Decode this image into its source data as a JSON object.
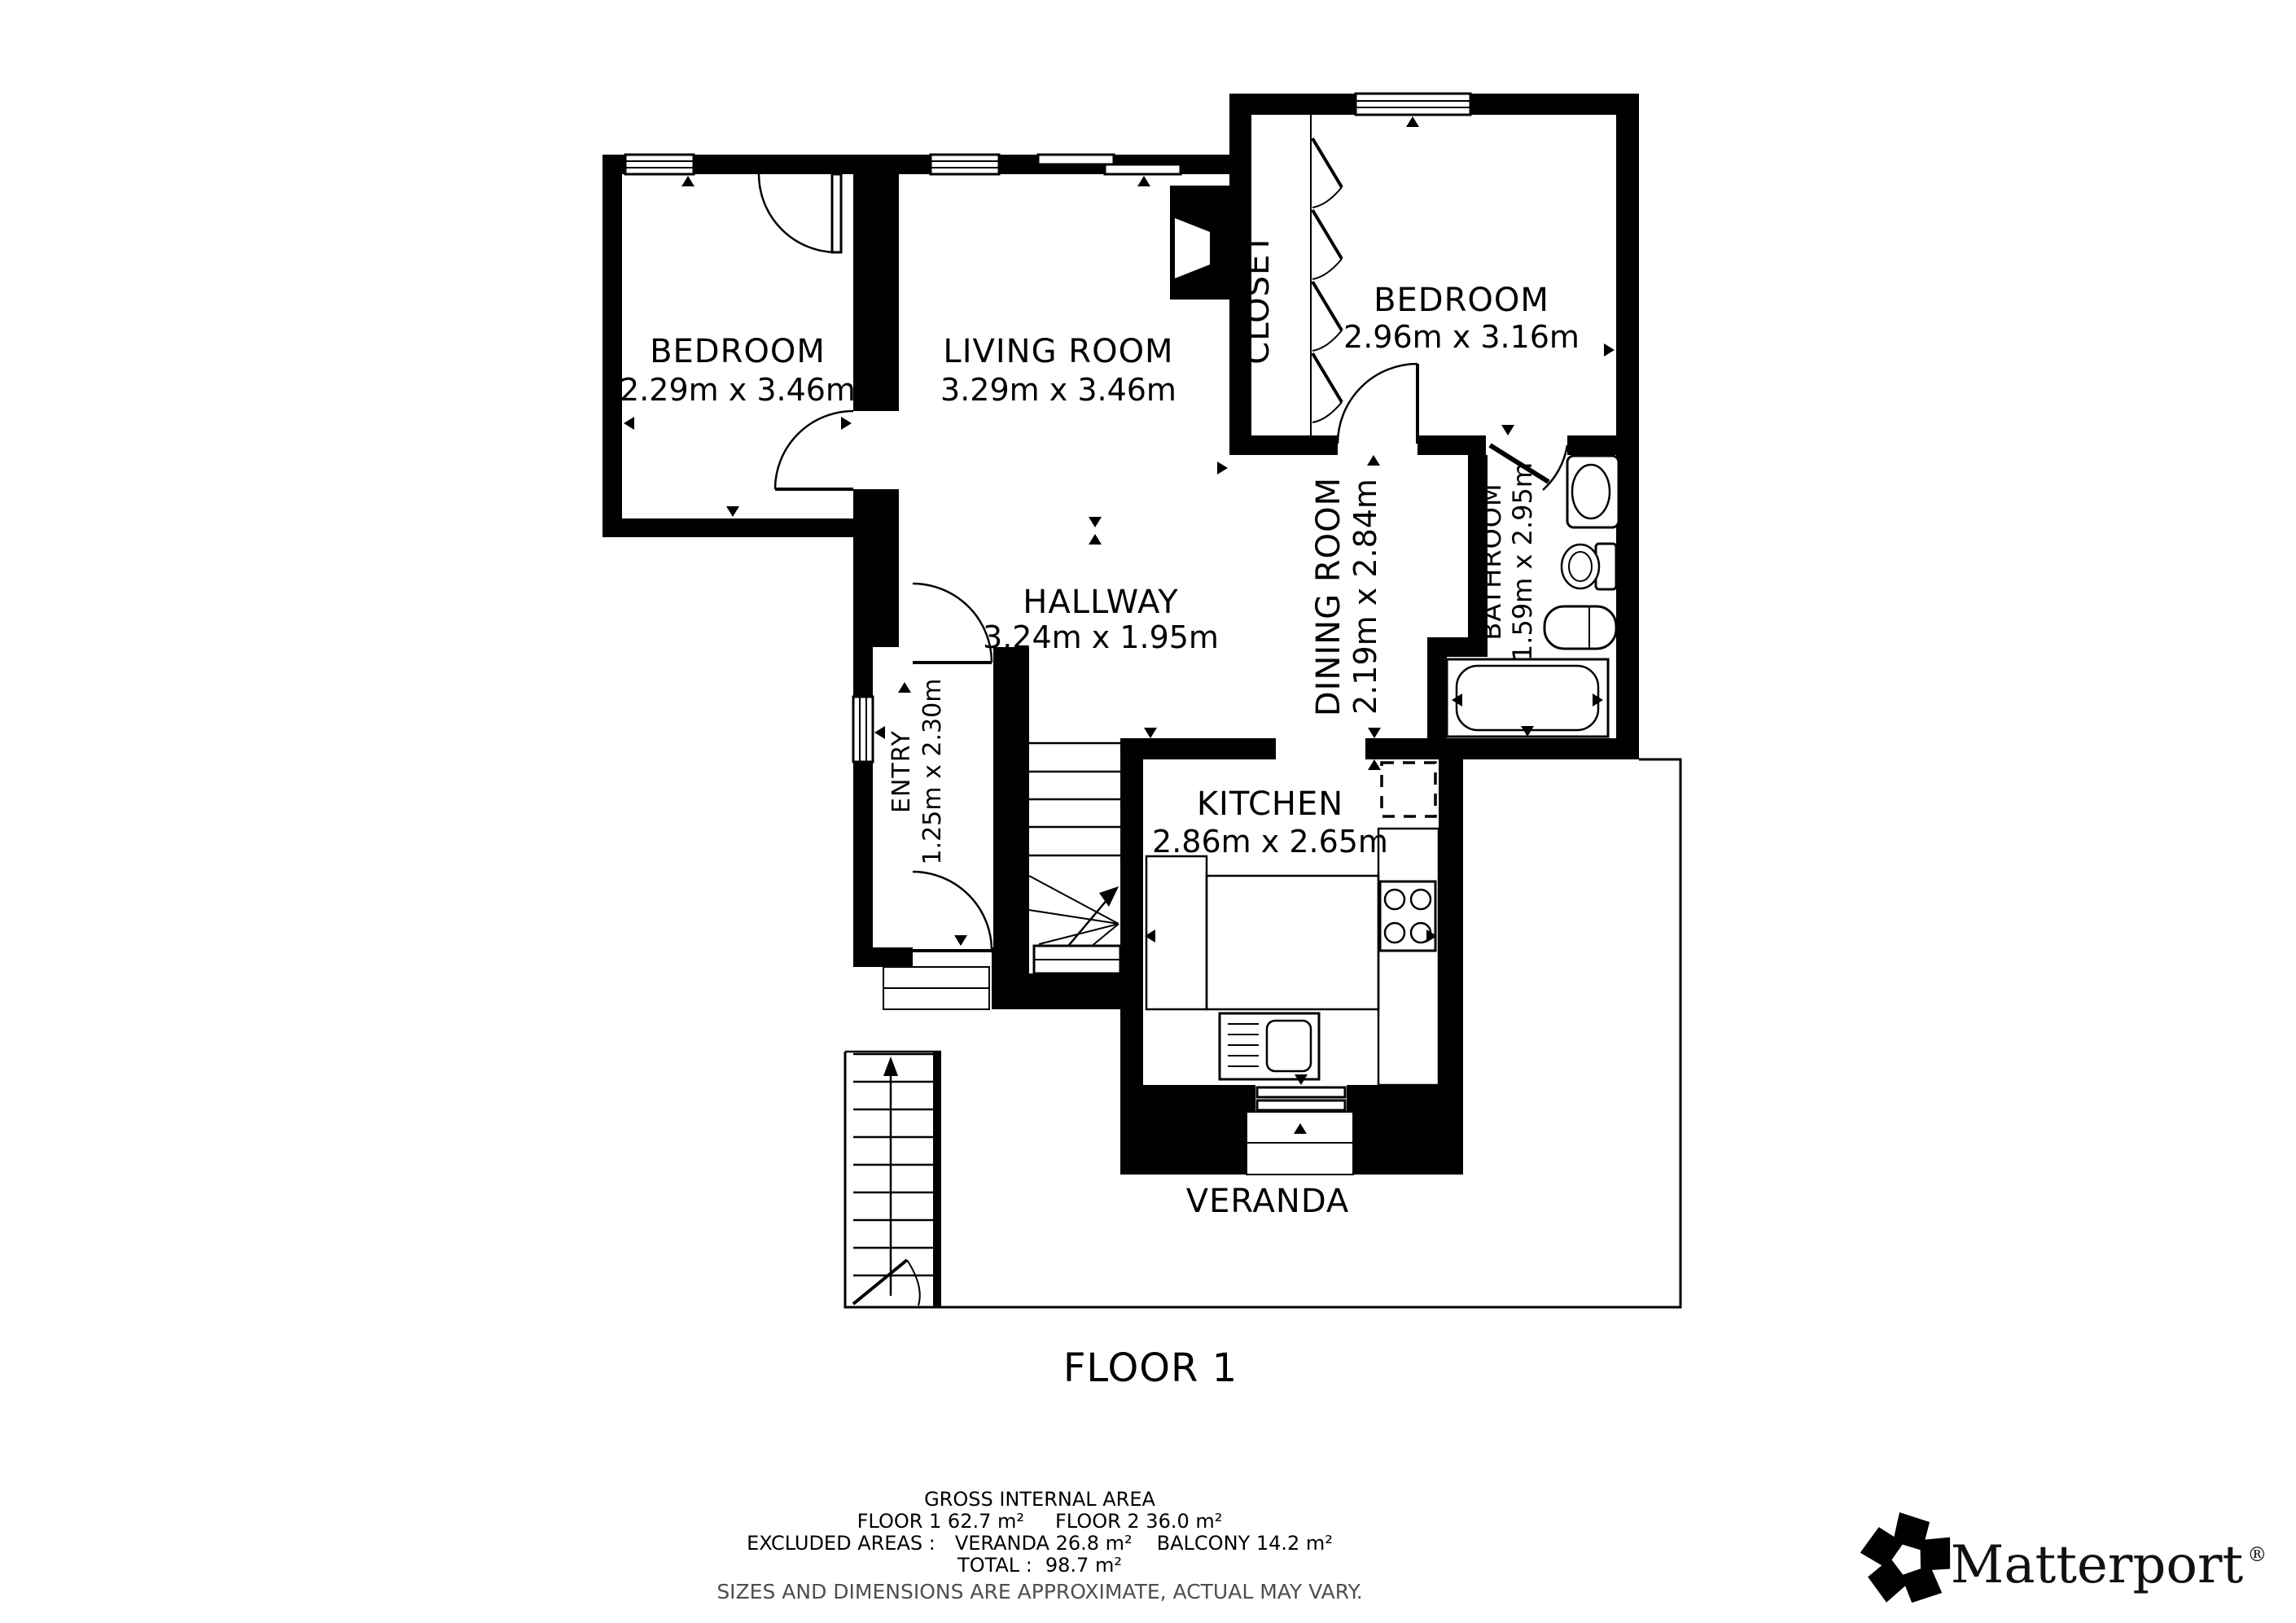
{
  "plan": {
    "floor_label": "FLOOR 1",
    "rooms": {
      "bedroom1": {
        "name": "BEDROOM",
        "dims": "2.29m x 3.46m"
      },
      "living": {
        "name": "LIVING ROOM",
        "dims": "3.29m x 3.46m"
      },
      "closet": {
        "name": "CLOSET"
      },
      "bedroom2": {
        "name": "BEDROOM",
        "dims": "2.96m x 3.16m"
      },
      "dining": {
        "name": "DINING ROOM",
        "dims": "2.19m x 2.84m"
      },
      "bathroom": {
        "name": "BATHROOM",
        "dims": "1.59m x 2.95m"
      },
      "hallway": {
        "name": "HALLWAY",
        "dims": "3.24m x 1.95m"
      },
      "entry": {
        "name": "ENTRY",
        "dims": "1.25m x 2.30m"
      },
      "kitchen": {
        "name": "KITCHEN",
        "dims": "2.86m x 2.65m"
      },
      "veranda": {
        "name": "VERANDA"
      }
    }
  },
  "footer": {
    "title": "GROSS INTERNAL AREA",
    "line2a": "FLOOR 1 62.7 m²",
    "line2b": "FLOOR 2 36.0 m²",
    "line3a": "EXCLUDED AREAS :",
    "line3b": "VERANDA 26.8 m²",
    "line3c": "BALCONY 14.2 m²",
    "line4a": "TOTAL :",
    "line4b": "98.7 m²",
    "disclaimer": "SIZES AND DIMENSIONS ARE APPROXIMATE, ACTUAL MAY VARY."
  },
  "branding": {
    "name": "Matterport",
    "registered": "®"
  },
  "colors": {
    "wall": "#000000",
    "background": "#ffffff",
    "disclaimer": "#4e4e4e"
  }
}
